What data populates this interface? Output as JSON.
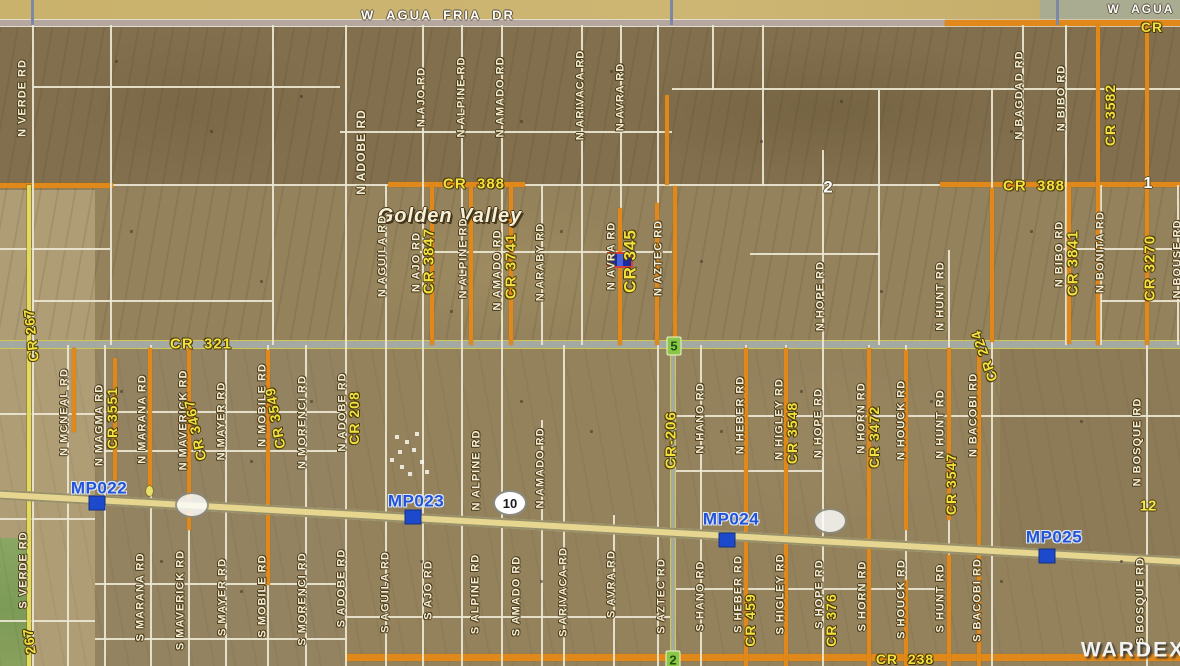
{
  "map_title": "Golden Valley parcel map",
  "colors": {
    "terrain_base": "#94825d",
    "county_road_orange": "#e0891a",
    "cr_label_yellow": "#f2e13e",
    "road_label_cream": "#f4eed6",
    "milepost_blue": "#2353d6",
    "milepost_square_blue": "#1d49cc",
    "highway_fill": "#e7d690",
    "subject_fill": "#1b2aa0",
    "subject_border": "#d6403a",
    "badge_green": "#8cc648",
    "field_green": "#7c9b57"
  },
  "labels": [
    {
      "t": "W  AGUA  FRIA  DR",
      "x": 438,
      "y": 15,
      "c": "white",
      "s": 13
    },
    {
      "t": "W  AGUA",
      "x": 1141,
      "y": 9,
      "c": "white",
      "s": 12
    },
    {
      "t": "CR",
      "x": 1152,
      "y": 27,
      "c": "cry",
      "s": 14
    },
    {
      "t": "N VERDE RD",
      "x": 23,
      "y": 98,
      "c": "road",
      "v": 1,
      "s": 11
    },
    {
      "t": "N ADOBE RD",
      "x": 361,
      "y": 152,
      "c": "road",
      "v": 1,
      "s": 12
    },
    {
      "t": "N AJO RD",
      "x": 422,
      "y": 97,
      "c": "road",
      "v": 1,
      "s": 11
    },
    {
      "t": "N ALPINE RD",
      "x": 462,
      "y": 97,
      "c": "road",
      "v": 1,
      "s": 11
    },
    {
      "t": "N AMADO RD",
      "x": 501,
      "y": 97,
      "c": "road",
      "v": 1,
      "s": 11
    },
    {
      "t": "N ARIVACA RD",
      "x": 581,
      "y": 95,
      "c": "road",
      "v": 1,
      "s": 11
    },
    {
      "t": "N AVRA RD",
      "x": 621,
      "y": 97,
      "c": "road",
      "v": 1,
      "s": 11
    },
    {
      "t": "N BAGDAD RD",
      "x": 1020,
      "y": 95,
      "c": "road",
      "v": 1,
      "s": 11
    },
    {
      "t": "N BIBO RD",
      "x": 1062,
      "y": 98,
      "c": "road",
      "v": 1,
      "s": 11
    },
    {
      "t": "CR 3582",
      "x": 1110,
      "y": 115,
      "c": "cry",
      "v": 1,
      "s": 14
    },
    {
      "t": "CR  388",
      "x": 474,
      "y": 184,
      "c": "cry",
      "s": 15
    },
    {
      "t": "CR  388",
      "x": 1034,
      "y": 186,
      "c": "cry",
      "s": 15
    },
    {
      "t": "Golden Valley",
      "x": 450,
      "y": 216,
      "c": "place",
      "s": 20
    },
    {
      "t": "2",
      "x": 828,
      "y": 187,
      "c": "numw",
      "s": 17
    },
    {
      "t": "1",
      "x": 1148,
      "y": 184,
      "c": "numw",
      "s": 16
    },
    {
      "t": "N AGUILA RD",
      "x": 383,
      "y": 256,
      "c": "road",
      "v": 1,
      "s": 11
    },
    {
      "t": "N AJO RD",
      "x": 417,
      "y": 262,
      "c": "road",
      "v": 1,
      "s": 11
    },
    {
      "t": "CR 3847",
      "x": 429,
      "y": 261,
      "c": "cry",
      "v": 1,
      "s": 15
    },
    {
      "t": "N ALPINE RD",
      "x": 464,
      "y": 258,
      "c": "road",
      "v": 1,
      "s": 11
    },
    {
      "t": "N AMADO RD",
      "x": 498,
      "y": 270,
      "c": "road",
      "v": 1,
      "s": 11
    },
    {
      "t": "CR 3741",
      "x": 511,
      "y": 266,
      "c": "cry",
      "v": 1,
      "s": 15
    },
    {
      "t": "N ARABY RD",
      "x": 541,
      "y": 262,
      "c": "road",
      "v": 1,
      "s": 11
    },
    {
      "t": "N AVRA RD",
      "x": 612,
      "y": 256,
      "c": "road",
      "v": 1,
      "s": 11
    },
    {
      "t": "CR 345",
      "x": 630,
      "y": 261,
      "c": "cry",
      "v": 1,
      "s": 17
    },
    {
      "t": "N AZTEC RD",
      "x": 659,
      "y": 258,
      "c": "road",
      "v": 1,
      "s": 11
    },
    {
      "t": "N BIBO RD",
      "x": 1060,
      "y": 254,
      "c": "road",
      "v": 1,
      "s": 11
    },
    {
      "t": "CR 3841",
      "x": 1073,
      "y": 263,
      "c": "cry",
      "v": 1,
      "s": 15
    },
    {
      "t": "N BONITA RD",
      "x": 1101,
      "y": 252,
      "c": "road",
      "v": 1,
      "s": 11
    },
    {
      "t": "CR 3270",
      "x": 1150,
      "y": 268,
      "c": "cry",
      "v": 1,
      "s": 15
    },
    {
      "t": "N BOUSE RD",
      "x": 1178,
      "y": 259,
      "c": "road",
      "v": 1,
      "s": 11
    },
    {
      "t": "N HOPE RD",
      "x": 821,
      "y": 296,
      "c": "road",
      "v": 1,
      "s": 11
    },
    {
      "t": "N HUNT RD",
      "x": 941,
      "y": 296,
      "c": "road",
      "v": 1,
      "s": 11
    },
    {
      "t": "CR  321",
      "x": 201,
      "y": 344,
      "c": "cry",
      "s": 15
    },
    {
      "t": "CR 267",
      "x": 31,
      "y": 335,
      "c": "cry",
      "v": 1,
      "s": 14,
      "r": -6
    },
    {
      "t": "N MCNEAL RD",
      "x": 65,
      "y": 412,
      "c": "road",
      "v": 1,
      "s": 11
    },
    {
      "t": "N MAGMA RD",
      "x": 100,
      "y": 425,
      "c": "road",
      "v": 1,
      "s": 11
    },
    {
      "t": "CR 3551",
      "x": 112,
      "y": 418,
      "c": "cry",
      "v": 1,
      "s": 14
    },
    {
      "t": "N MARANA RD",
      "x": 143,
      "y": 419,
      "c": "road",
      "v": 1,
      "s": 11
    },
    {
      "t": "N MAVERICK RD",
      "x": 184,
      "y": 420,
      "c": "road",
      "v": 1,
      "s": 11
    },
    {
      "t": "CR 3467",
      "x": 195,
      "y": 430,
      "c": "cry",
      "v": 1,
      "s": 14,
      "r": -12
    },
    {
      "t": "N MAYER RD",
      "x": 222,
      "y": 421,
      "c": "road",
      "v": 1,
      "s": 11
    },
    {
      "t": "N MOBILE RD",
      "x": 263,
      "y": 405,
      "c": "road",
      "v": 1,
      "s": 11
    },
    {
      "t": "CR 3549",
      "x": 275,
      "y": 418,
      "c": "cry",
      "v": 1,
      "s": 14,
      "r": -10
    },
    {
      "t": "N MORENCI RD",
      "x": 303,
      "y": 422,
      "c": "road",
      "v": 1,
      "s": 11
    },
    {
      "t": "N ADOBE RD",
      "x": 343,
      "y": 412,
      "c": "road",
      "v": 1,
      "s": 11
    },
    {
      "t": "CR 208",
      "x": 354,
      "y": 418,
      "c": "cry",
      "v": 1,
      "s": 14
    },
    {
      "t": "N ALPINE RD",
      "x": 477,
      "y": 470,
      "c": "road",
      "v": 1,
      "s": 11
    },
    {
      "t": "N AMADO RD",
      "x": 541,
      "y": 468,
      "c": "road",
      "v": 1,
      "s": 11
    },
    {
      "t": "CR-206",
      "x": 671,
      "y": 440,
      "c": "cry",
      "v": 1,
      "s": 15
    },
    {
      "t": "N HANO RD",
      "x": 701,
      "y": 418,
      "c": "road",
      "v": 1,
      "s": 11
    },
    {
      "t": "N HEBER RD",
      "x": 741,
      "y": 415,
      "c": "road",
      "v": 1,
      "s": 11
    },
    {
      "t": "N HIGLEY RD",
      "x": 780,
      "y": 419,
      "c": "road",
      "v": 1,
      "s": 11
    },
    {
      "t": "CR 3548",
      "x": 792,
      "y": 433,
      "c": "cry",
      "v": 1,
      "s": 14
    },
    {
      "t": "N HOPE RD",
      "x": 819,
      "y": 423,
      "c": "road",
      "v": 1,
      "s": 11
    },
    {
      "t": "N HORN RD",
      "x": 862,
      "y": 418,
      "c": "road",
      "v": 1,
      "s": 11
    },
    {
      "t": "CR 3472",
      "x": 874,
      "y": 437,
      "c": "cry",
      "v": 1,
      "s": 14
    },
    {
      "t": "N HOUCK RD",
      "x": 902,
      "y": 420,
      "c": "road",
      "v": 1,
      "s": 11
    },
    {
      "t": "N HUNT RD",
      "x": 941,
      "y": 424,
      "c": "road",
      "v": 1,
      "s": 11
    },
    {
      "t": "CR 3547",
      "x": 951,
      "y": 484,
      "c": "cry",
      "v": 1,
      "s": 14
    },
    {
      "t": "N BACOBI RD",
      "x": 974,
      "y": 415,
      "c": "road",
      "v": 1,
      "s": 11
    },
    {
      "t": "CR 224",
      "x": 984,
      "y": 356,
      "c": "cry",
      "v": 1,
      "s": 14,
      "r": -20
    },
    {
      "t": "N BOSQUE RD",
      "x": 1138,
      "y": 442,
      "c": "road",
      "v": 1,
      "s": 11
    },
    {
      "t": "MP022",
      "x": 99,
      "y": 488,
      "c": "mp",
      "s": 17
    },
    {
      "t": "MP023",
      "x": 416,
      "y": 501,
      "c": "mp",
      "s": 17
    },
    {
      "t": "MP024",
      "x": 731,
      "y": 519,
      "c": "mp",
      "s": 17
    },
    {
      "t": "MP025",
      "x": 1054,
      "y": 537,
      "c": "mp",
      "s": 17
    },
    {
      "t": "12",
      "x": 1148,
      "y": 506,
      "c": "numy",
      "s": 15
    },
    {
      "t": "S VERDE RD",
      "x": 24,
      "y": 570,
      "c": "road",
      "v": 1,
      "s": 11
    },
    {
      "t": "267",
      "x": 29,
      "y": 641,
      "c": "cry",
      "v": 1,
      "s": 14,
      "r": -8
    },
    {
      "t": "S MARANA RD",
      "x": 141,
      "y": 597,
      "c": "road",
      "v": 1,
      "s": 11
    },
    {
      "t": "S MAVERICK RD",
      "x": 181,
      "y": 600,
      "c": "road",
      "v": 1,
      "s": 11
    },
    {
      "t": "S MAYER RD",
      "x": 223,
      "y": 597,
      "c": "road",
      "v": 1,
      "s": 11
    },
    {
      "t": "S MOBILE RD",
      "x": 263,
      "y": 596,
      "c": "road",
      "v": 1,
      "s": 11
    },
    {
      "t": "S MORENCI RD",
      "x": 303,
      "y": 599,
      "c": "road",
      "v": 1,
      "s": 11
    },
    {
      "t": "S ADOBE RD",
      "x": 342,
      "y": 588,
      "c": "road",
      "v": 1,
      "s": 11
    },
    {
      "t": "S AGUILA RD",
      "x": 386,
      "y": 592,
      "c": "road",
      "v": 1,
      "s": 11
    },
    {
      "t": "S AJO RD",
      "x": 429,
      "y": 590,
      "c": "road",
      "v": 1,
      "s": 11
    },
    {
      "t": "S ALPINE RD",
      "x": 476,
      "y": 594,
      "c": "road",
      "v": 1,
      "s": 11
    },
    {
      "t": "S AMADO RD",
      "x": 517,
      "y": 596,
      "c": "road",
      "v": 1,
      "s": 11
    },
    {
      "t": "S ARIVACA RD",
      "x": 564,
      "y": 592,
      "c": "road",
      "v": 1,
      "s": 11
    },
    {
      "t": "S AVRA RD",
      "x": 612,
      "y": 584,
      "c": "road",
      "v": 1,
      "s": 11
    },
    {
      "t": "S AZTEC RD",
      "x": 662,
      "y": 596,
      "c": "road",
      "v": 1,
      "s": 11
    },
    {
      "t": "S HANO RD",
      "x": 701,
      "y": 596,
      "c": "road",
      "v": 1,
      "s": 11
    },
    {
      "t": "S HEBER RD",
      "x": 739,
      "y": 594,
      "c": "road",
      "v": 1,
      "s": 11
    },
    {
      "t": "CR 459",
      "x": 750,
      "y": 620,
      "c": "cry",
      "v": 1,
      "s": 14
    },
    {
      "t": "S HIGLEY RD",
      "x": 781,
      "y": 594,
      "c": "road",
      "v": 1,
      "s": 11
    },
    {
      "t": "S HOPE RD",
      "x": 820,
      "y": 594,
      "c": "road",
      "v": 1,
      "s": 11
    },
    {
      "t": "CR 376",
      "x": 831,
      "y": 620,
      "c": "cry",
      "v": 1,
      "s": 14
    },
    {
      "t": "S HORN RD",
      "x": 863,
      "y": 596,
      "c": "road",
      "v": 1,
      "s": 11
    },
    {
      "t": "S HOUCK RD",
      "x": 902,
      "y": 599,
      "c": "road",
      "v": 1,
      "s": 11
    },
    {
      "t": "S HUNT RD",
      "x": 941,
      "y": 598,
      "c": "road",
      "v": 1,
      "s": 11
    },
    {
      "t": "S BACOBI RD",
      "x": 978,
      "y": 600,
      "c": "road",
      "v": 1,
      "s": 11
    },
    {
      "t": "S BOSQUE RD",
      "x": 1141,
      "y": 601,
      "c": "road",
      "v": 1,
      "s": 11
    },
    {
      "t": "CR  238",
      "x": 905,
      "y": 659,
      "c": "cry",
      "s": 14
    },
    {
      "t": "WARDEX",
      "x": 1133,
      "y": 650,
      "c": "wm",
      "s": 21
    }
  ],
  "markers": {
    "subject_marker": {
      "x": 607,
      "y": 252,
      "w": 26,
      "h": 16,
      "fill": "#1b2aa0",
      "border": "#d6403a"
    },
    "milepost_squares": [
      {
        "x": 97,
        "y": 503
      },
      {
        "x": 413,
        "y": 517
      },
      {
        "x": 727,
        "y": 540
      },
      {
        "x": 1047,
        "y": 556
      }
    ],
    "highway_shields": [
      {
        "text": "10",
        "x": 510,
        "y": 503
      },
      {
        "text": "",
        "x": 192,
        "y": 505
      },
      {
        "text": "",
        "x": 830,
        "y": 521
      }
    ],
    "section_badges": [
      {
        "text": "5",
        "x": 674,
        "y": 346
      },
      {
        "text": "2",
        "x": 673,
        "y": 660
      }
    ]
  }
}
